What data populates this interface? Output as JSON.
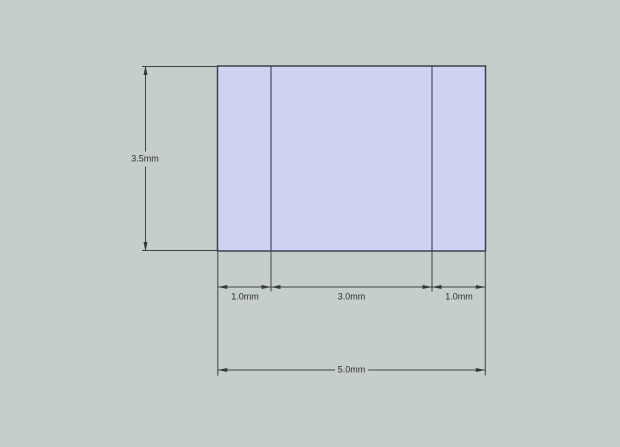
{
  "canvas": {
    "width_px": 620,
    "height_px": 447,
    "background_color": "#c6cecc"
  },
  "drawing": {
    "kind": "dimensioned cross-section drawing",
    "face": {
      "fill_color": "#cdd3f0",
      "edge_color": "#3a4050",
      "height_mm": 3.5,
      "total_width_mm": 5.0,
      "segment_widths_mm": [
        1.0,
        3.0,
        1.0
      ]
    },
    "dimension_style": {
      "line_color": "#424242",
      "text_color": "#2e2e2e"
    },
    "dimensions": [
      {
        "id": "height",
        "label": "3.5mm"
      },
      {
        "id": "segment-left",
        "label": "1.0mm"
      },
      {
        "id": "segment-middle",
        "label": "3.0mm"
      },
      {
        "id": "segment-right",
        "label": "1.0mm"
      },
      {
        "id": "overall-width",
        "label": "5.0mm"
      }
    ]
  }
}
